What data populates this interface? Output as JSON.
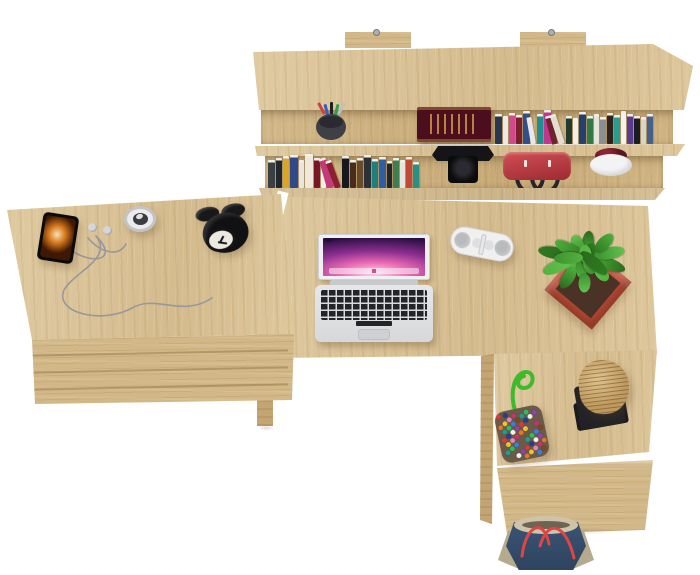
{
  "palette": {
    "background": "#ffffff",
    "wood_top": "#dcc496",
    "wood_front": "#d2b787",
    "wood_side": "#c2a572",
    "wood_recess": "#cdb07c"
  },
  "shelf": {
    "label": "wall shelf with books",
    "pencil_cup": {
      "cup_color": "#3f3f46",
      "pen_colors": [
        "#d04040",
        "#3060c0",
        "#202020",
        "#30a050",
        "#c0c0c0"
      ]
    },
    "featured_book": {
      "cover": "#4a0e1d",
      "ornament": "#d4a046"
    },
    "upper_books": [
      {
        "c": "#2a3550",
        "w": 7,
        "h": 30
      },
      {
        "c": "#ece9e4",
        "w": 5,
        "h": 28
      },
      {
        "c": "#d04a8c",
        "w": 6,
        "h": 31
      },
      {
        "c": "#7a1f2e",
        "w": 6,
        "h": 29
      },
      {
        "c": "#324f8a",
        "w": 7,
        "h": 33
      },
      {
        "c": "#e8e8e8",
        "w": 5,
        "h": 27,
        "lean": -10
      },
      {
        "c": "#1e8f8f",
        "w": 6,
        "h": 30
      },
      {
        "c": "#c2358c",
        "w": 7,
        "h": 34
      },
      {
        "c": "#6b2430",
        "w": 6,
        "h": 29,
        "lean": -14
      },
      {
        "c": "#e4ddd0",
        "w": 6,
        "h": 31,
        "lean": -18
      },
      {
        "c": "#203a2c",
        "w": 6,
        "h": 28
      },
      {
        "c": "#f0efe9",
        "w": 5,
        "h": 26
      },
      {
        "c": "#24406e",
        "w": 7,
        "h": 32
      },
      {
        "c": "#2f7a46",
        "w": 6,
        "h": 28
      },
      {
        "c": "#e8e4da",
        "w": 5,
        "h": 30
      },
      {
        "c": "#8a8f94",
        "w": 6,
        "h": 27
      },
      {
        "c": "#32221e",
        "w": 6,
        "h": 31
      },
      {
        "c": "#2a9d8f",
        "w": 6,
        "h": 29
      },
      {
        "c": "#f4f2ee",
        "w": 5,
        "h": 33
      },
      {
        "c": "#5b3a8e",
        "w": 6,
        "h": 30
      },
      {
        "c": "#1c1c24",
        "w": 6,
        "h": 28
      },
      {
        "c": "#d8d4c8",
        "w": 5,
        "h": 27
      },
      {
        "c": "#46608c",
        "w": 6,
        "h": 30
      }
    ],
    "lower_books": [
      {
        "c": "#3a3f44",
        "w": 7,
        "h": 28
      },
      {
        "c": "#23272b",
        "w": 6,
        "h": 30
      },
      {
        "c": "#d9a62a",
        "w": 6,
        "h": 32
      },
      {
        "c": "#2c4a8c",
        "w": 8,
        "h": 33
      },
      {
        "c": "#e9e6df",
        "w": 5,
        "h": 28
      },
      {
        "c": "#efe9dc",
        "w": 8,
        "h": 34
      },
      {
        "c": "#7a1525",
        "w": 6,
        "h": 30
      },
      {
        "c": "#f2eee6",
        "w": 5,
        "h": 27
      },
      {
        "c": "#c23a78",
        "w": 7,
        "h": 31,
        "lean": -16
      },
      {
        "c": "#8c2030",
        "w": 6,
        "h": 29,
        "lean": -20
      },
      {
        "c": "#17181c",
        "w": 7,
        "h": 32
      },
      {
        "c": "#4a2c1c",
        "w": 6,
        "h": 28
      },
      {
        "c": "#6b4a2a",
        "w": 6,
        "h": 30
      },
      {
        "c": "#2d3136",
        "w": 7,
        "h": 33
      },
      {
        "c": "#1f7f7a",
        "w": 6,
        "h": 29
      },
      {
        "c": "#2e5fa3",
        "w": 7,
        "h": 31
      },
      {
        "c": "#23262a",
        "w": 5,
        "h": 27
      },
      {
        "c": "#3f7f4f",
        "w": 6,
        "h": 30
      },
      {
        "c": "#e8e5de",
        "w": 5,
        "h": 28
      },
      {
        "c": "#c04a35",
        "w": 6,
        "h": 31
      },
      {
        "c": "#2a8f85",
        "w": 6,
        "h": 26
      }
    ],
    "camera": {
      "body": "#141416",
      "lens": "#0b0b0d"
    },
    "handbag": {
      "body_light": "#d04f54",
      "body_dark": "#9e2a32",
      "handle": "#26262a"
    },
    "planter": {
      "pot": "#f3f3f4",
      "foliage": "#5a1622"
    }
  },
  "cabinet": {
    "label": "side cabinet with drawers",
    "drawer_lines": 3,
    "phone": {
      "frame": "#0a0a0a",
      "screen_colors": [
        "#f6e2b8",
        "#d87a1e",
        "#3f1803"
      ]
    },
    "earbuds": {
      "shell": "#d6d6da",
      "center": "#8a8a8e",
      "cable": "#97979d"
    },
    "small_clock": {
      "ring": "#c4c4c6",
      "face": "#ebebed",
      "center": "#3b3b40"
    },
    "alarm_clock": {
      "body": "#111113",
      "face": "#ece9e0",
      "hands": "#1a1a1c"
    }
  },
  "desk": {
    "label": "main desk",
    "laptop": {
      "shell": "#e2e3e5",
      "key_color": "#232427",
      "screen_colors": [
        "#ffd9ec",
        "#ee6cb4",
        "#8c2f90",
        "#2a0e40"
      ],
      "dock_icons": [
        "#5aa0e0",
        "#9a5fc0",
        "#e05050",
        "#f0c040",
        "#50c070",
        "#e08030",
        "#30b0a8",
        "#e8e8f0",
        "#405068",
        "#d05090"
      ]
    },
    "speaker": {
      "body": "#f0f0f1",
      "grille": "#c7c8ca",
      "clasp": "#dedfe1"
    },
    "plant": {
      "pot": "#bf4f3a",
      "pot_inner": "#a83f2e",
      "leaf_count": 20,
      "leaf_colors": [
        "#2e7a21",
        "#3c9230",
        "#4fae3c",
        "#63c24e",
        "#2a6b1d",
        "#56b03f"
      ]
    }
  },
  "return_desk": {
    "label": "desk return with drawer",
    "bead_pouch": {
      "cord": "#3dbb2a",
      "base": "#6b5a4a",
      "bead_count": 46,
      "bead_colors": [
        "#d93a3a",
        "#3a7fd9",
        "#efc32f",
        "#8e44ad",
        "#2fbf59",
        "#e2772c",
        "#f5f1e8",
        "#1f9e8e",
        "#c2356f",
        "#23408f",
        "#7a4a20",
        "#e585b5"
      ]
    },
    "paper_block": {
      "paper": "#bf9a5e",
      "stand": "#222226",
      "base": "#1b1b1f"
    }
  },
  "floor": {
    "tote_bag": {
      "denim_light": "#3a5474",
      "denim_dark": "#2e4460",
      "trim": "#cfc3aa",
      "gusset": "#b5a98e",
      "strap": "#e04545",
      "slot": "#6e6452"
    }
  }
}
